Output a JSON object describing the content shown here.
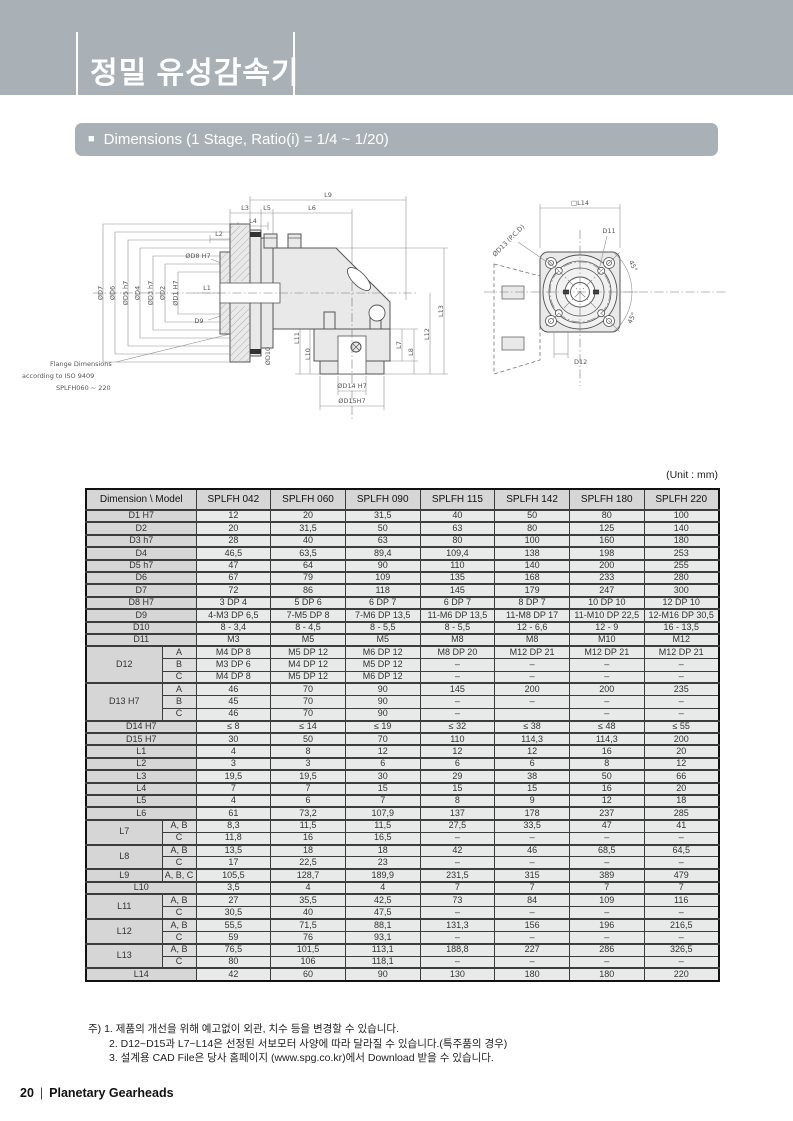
{
  "page": {
    "title": "정밀 유성감속기",
    "section_bullet": "■",
    "section_header": "Dimensions (1 Stage, Ratio(i) = 1/4 ~ 1/20)",
    "footer_page": "20",
    "footer_separator": "|",
    "footer_text": "Planetary Gearheads"
  },
  "colors": {
    "header_band": "#a9b0b6",
    "table_header_bg": "#d6d6d6",
    "table_cell_bg": "#e7eae8"
  },
  "figure_left": {
    "dims_top": [
      "L9",
      "L3",
      "L5",
      "L6",
      "L4",
      "L2"
    ],
    "dims_left": [
      "ØD7",
      "ØD6",
      "ØD5 h7",
      "ØD4",
      "ØD3 h7",
      "ØD2",
      "ØD1 H7"
    ],
    "callout_d8": "ØD8 H7",
    "callout_l1": "L1",
    "callout_d9": "D9",
    "callout_d10": "ØD10",
    "callout_d14": "ØD14  H7",
    "callout_d15": "ØD15H7",
    "dims_right": [
      "L7",
      "L8",
      "L12",
      "L13"
    ],
    "dims_bottom_left": [
      "L11",
      "L10"
    ],
    "note": [
      "Flange Dimensions",
      "according to ISO 9409",
      "SPLFH060 ~ 220"
    ]
  },
  "figure_right": {
    "label_l14": "□L14",
    "label_d13": "ØD13 (P.C.D)",
    "label_d11": "D11",
    "label_d12": "D12",
    "angle_top": "45°",
    "angle_bottom": "45°"
  },
  "table": {
    "unit": "(Unit : mm)",
    "header": [
      "Dimension \\ Model",
      "SPLFH 042",
      "SPLFH 060",
      "SPLFH 090",
      "SPLFH 115",
      "SPLFH 142",
      "SPLFH 180",
      "SPLFH 220"
    ],
    "rows": [
      {
        "label": "D1 H7",
        "span": 2,
        "values": [
          "12",
          "20",
          "31,5",
          "40",
          "50",
          "80",
          "100"
        ]
      },
      {
        "label": "D2",
        "span": 2,
        "values": [
          "20",
          "31,5",
          "50",
          "63",
          "80",
          "125",
          "140"
        ]
      },
      {
        "label": "D3 h7",
        "span": 2,
        "values": [
          "28",
          "40",
          "63",
          "80",
          "100",
          "160",
          "180"
        ]
      },
      {
        "label": "D4",
        "span": 2,
        "values": [
          "46,5",
          "63,5",
          "89,4",
          "109,4",
          "138",
          "198",
          "253"
        ]
      },
      {
        "label": "D5 h7",
        "span": 2,
        "values": [
          "47",
          "64",
          "90",
          "110",
          "140",
          "200",
          "255"
        ]
      },
      {
        "label": "D6",
        "span": 2,
        "values": [
          "67",
          "79",
          "109",
          "135",
          "168",
          "233",
          "280"
        ]
      },
      {
        "label": "D7",
        "span": 2,
        "values": [
          "72",
          "86",
          "118",
          "145",
          "179",
          "247",
          "300"
        ]
      },
      {
        "label": "D8 H7",
        "span": 2,
        "values": [
          "3  DP 4",
          "5 DP 6",
          "6 DP 7",
          "6 DP 7",
          "8 DP 7",
          "10 DP 10",
          "12 DP 10"
        ]
      },
      {
        "label": "D9",
        "span": 2,
        "values": [
          "4-M3 DP 6,5",
          "7-M5 DP 8",
          "7-M6 DP 13,5",
          "11-M6 DP 13,5",
          "11-M8 DP 17",
          "11-M10 DP 22,5",
          "12-M16 DP 30,5"
        ]
      },
      {
        "label": "D10",
        "span": 2,
        "values": [
          "8 - 3,4",
          "8 - 4,5",
          "8 - 5,5",
          "8 - 5,5",
          "12 - 6,6",
          "12 - 9",
          "16 - 13,5"
        ]
      },
      {
        "label": "D11",
        "span": 2,
        "values": [
          "M3",
          "M5",
          "M5",
          "M8",
          "M8",
          "M10",
          "M12"
        ]
      },
      {
        "label": "D12",
        "group": 3,
        "sub": "A",
        "values": [
          "M4 DP 8",
          "M5 DP 12",
          "M6 DP 12",
          "M8 DP 20",
          "M12 DP 21",
          "M12 DP 21",
          "M12 DP 21"
        ]
      },
      {
        "sub": "B",
        "values": [
          "M3 DP 6",
          "M4 DP 12",
          "M5 DP 12",
          "–",
          "–",
          "–",
          "–"
        ]
      },
      {
        "sub": "C",
        "values": [
          "M4 DP 8",
          "M5 DP 12",
          "M6 DP 12",
          "–",
          "–",
          "–",
          "–"
        ]
      },
      {
        "label": "D13 H7",
        "group": 3,
        "sub": "A",
        "values": [
          "46",
          "70",
          "90",
          "145",
          "200",
          "200",
          "235"
        ]
      },
      {
        "sub": "B",
        "values": [
          "45",
          "70",
          "90",
          "–",
          "–",
          "–",
          "–"
        ]
      },
      {
        "sub": "C",
        "values": [
          "46",
          "70",
          "90",
          "–",
          "",
          "–",
          "–"
        ]
      },
      {
        "label": "D14 H7",
        "span": 2,
        "values": [
          "≤ 8",
          "≤ 14",
          "≤ 19",
          "≤ 32",
          "≤ 38",
          "≤ 48",
          "≤ 55"
        ]
      },
      {
        "label": "D15 H7",
        "span": 2,
        "values": [
          "30",
          "50",
          "70",
          "110",
          "114,3",
          "114,3",
          "200"
        ]
      },
      {
        "label": "L1",
        "span": 2,
        "values": [
          "4",
          "8",
          "12",
          "12",
          "12",
          "16",
          "20"
        ]
      },
      {
        "label": "L2",
        "span": 2,
        "values": [
          "3",
          "3",
          "6",
          "6",
          "6",
          "8",
          "12"
        ]
      },
      {
        "label": "L3",
        "span": 2,
        "values": [
          "19,5",
          "19,5",
          "30",
          "29",
          "38",
          "50",
          "66"
        ]
      },
      {
        "label": "L4",
        "span": 2,
        "values": [
          "7",
          "7",
          "15",
          "15",
          "15",
          "16",
          "20"
        ]
      },
      {
        "label": "L5",
        "span": 2,
        "values": [
          "4",
          "6",
          "7",
          "8",
          "9",
          "12",
          "18"
        ]
      },
      {
        "label": "L6",
        "span": 2,
        "values": [
          "61",
          "73,2",
          "107,9",
          "137",
          "178",
          "237",
          "285"
        ]
      },
      {
        "label": "L7",
        "group": 2,
        "sub": "A, B",
        "values": [
          "8,3",
          "11,5",
          "11,5",
          "27,5",
          "33,5",
          "47",
          "41"
        ]
      },
      {
        "sub": "C",
        "values": [
          "11,8",
          "16",
          "16,5",
          "–",
          "–",
          "–",
          "–"
        ]
      },
      {
        "label": "L8",
        "group": 2,
        "sub": "A, B",
        "values": [
          "13,5",
          "18",
          "18",
          "42",
          "46",
          "68,5",
          "64,5"
        ]
      },
      {
        "sub": "C",
        "values": [
          "17",
          "22,5",
          "23",
          "–",
          "–",
          "–",
          "–"
        ]
      },
      {
        "label": "L9",
        "group": 1,
        "sub": "A, B, C",
        "values": [
          "105,5",
          "128,7",
          "189,9",
          "231,5",
          "315",
          "389",
          "479"
        ]
      },
      {
        "label": "L10",
        "span": 2,
        "values": [
          "3,5",
          "4",
          "4",
          "7",
          "7",
          "7",
          "7"
        ]
      },
      {
        "label": "L11",
        "group": 2,
        "sub": "A, B",
        "values": [
          "27",
          "35,5",
          "42,5",
          "73",
          "84",
          "109",
          "116"
        ]
      },
      {
        "sub": "C",
        "values": [
          "30,5",
          "40",
          "47,5",
          "–",
          "–",
          "–",
          "–"
        ]
      },
      {
        "label": "L12",
        "group": 2,
        "sub": "A, B",
        "values": [
          "55,5",
          "71,5",
          "88,1",
          "131,3",
          "156",
          "196",
          "216,5"
        ]
      },
      {
        "sub": "C",
        "values": [
          "59",
          "76",
          "93,1",
          "–",
          "–",
          "–",
          "–"
        ]
      },
      {
        "label": "L13",
        "group": 2,
        "sub": "A, B",
        "values": [
          "76,5",
          "101,5",
          "113,1",
          "188,8",
          "227",
          "286",
          "326,5"
        ]
      },
      {
        "sub": "C",
        "values": [
          "80",
          "106",
          "118,1",
          "–",
          "–",
          "–",
          "–"
        ]
      },
      {
        "label": "L14",
        "span": 2,
        "values": [
          "42",
          "60",
          "90",
          "130",
          "180",
          "180",
          "220"
        ]
      }
    ]
  },
  "notes": {
    "items": [
      "주) 1. 제품의 개선을 위해 예고없이 외관, 치수 등을 변경할 수 있습니다.",
      "2. D12~D15과 L7~L14은 선정된 서보모터 사양에 따라 달라질 수 있습니다.(특주품의 경우)",
      "3. 설계용 CAD File은 당사 홈페이지 (www.spg.co.kr)에서 Download 받을 수 있습니다."
    ]
  }
}
